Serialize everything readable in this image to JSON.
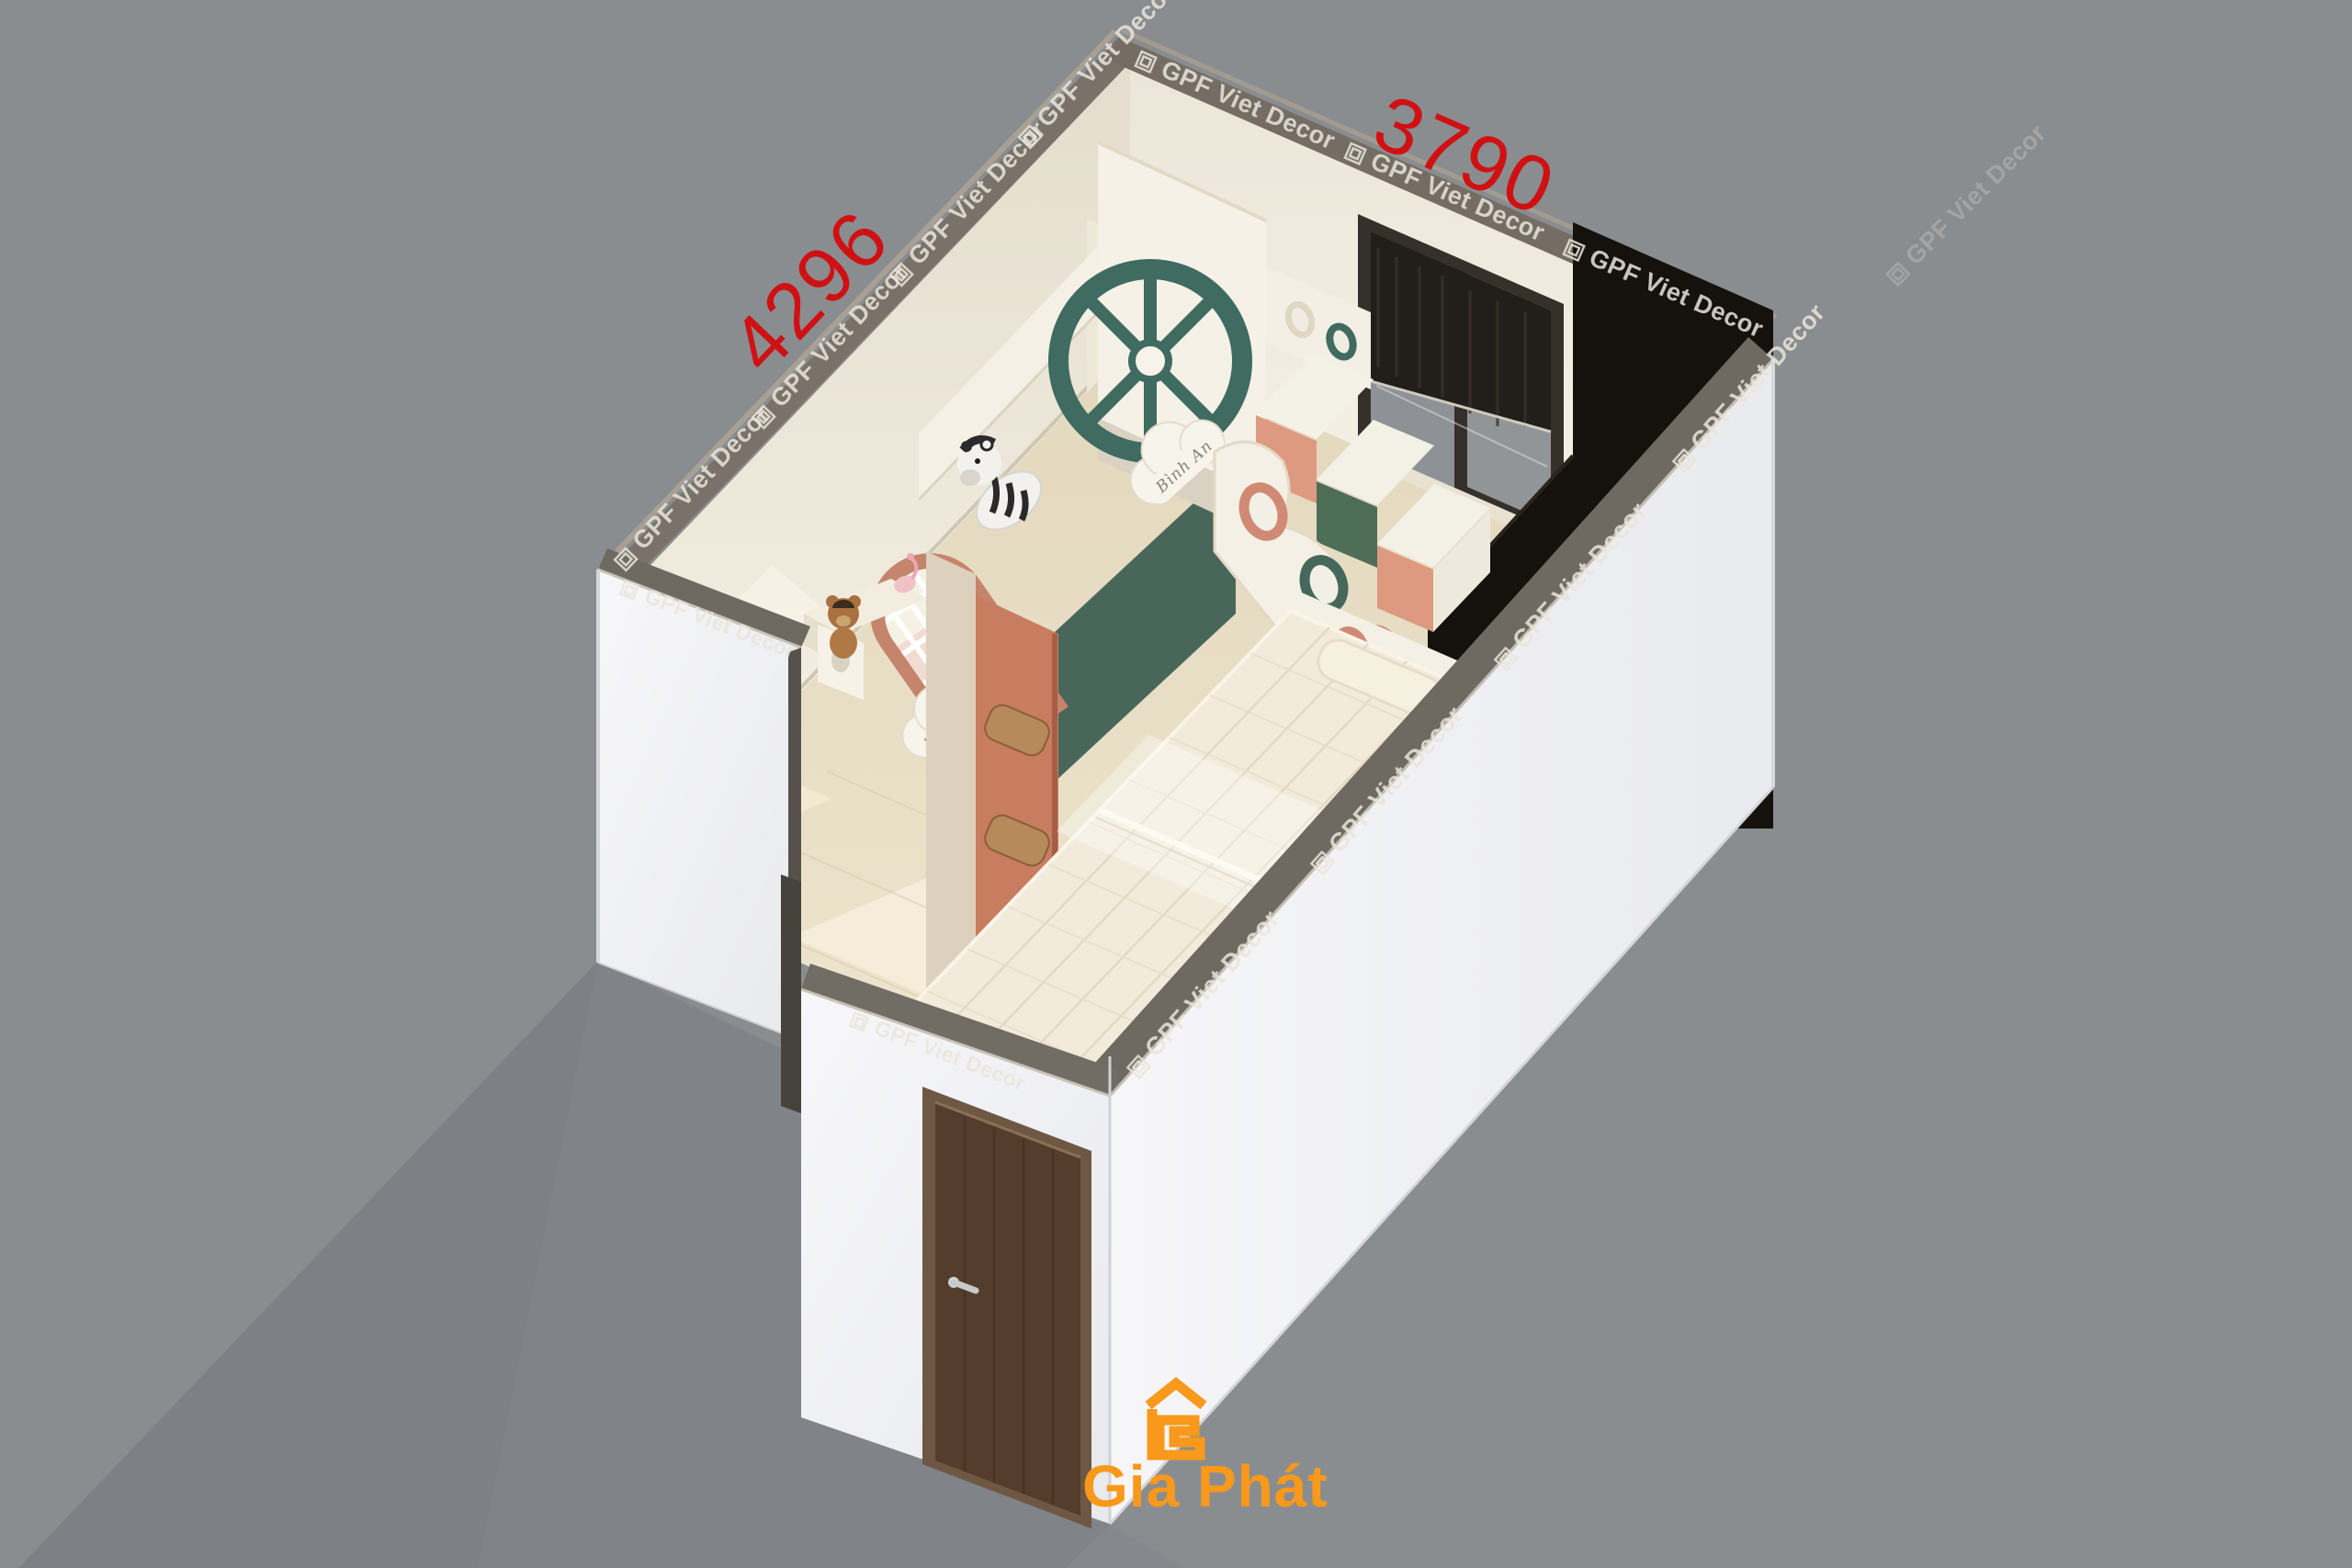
{
  "scene": {
    "type": "isometric-interior-render",
    "subject": "kids bedroom cutaway with bunk bed",
    "background_color": "#8a8d90"
  },
  "dimension_labels": {
    "left_wall": "4296",
    "back_wall": "3790",
    "color": "#d01114"
  },
  "watermark": {
    "text": "GPF Viet Decor"
  },
  "brand": {
    "name": "Gia Phát",
    "color": "#f8991c"
  },
  "bunk_bed": {
    "upper_bunk_nameplate": "Bình An",
    "lower_bunk_nameplate": "Bảo Anh"
  },
  "palette": {
    "wall_cream": "#efe9db",
    "floor_wood": "#e8dec6",
    "exterior_white": "#f5f5f8",
    "wall_cap_gray": "#6f6a62",
    "shadow_gray": "#7d8185",
    "teal_accent": "#3f6b61",
    "terracotta_accent": "#c87c60",
    "salmon_drawer": "#dd9a80",
    "green_drawer": "#4e6e58",
    "dark_green_panel": "#48675a",
    "bed_wood": "#7d4e2e",
    "mattress": "#f2ebdb",
    "door_brown": "#543d2c",
    "wardrobe_dark": "#15120e",
    "window_frame": "#35302a"
  }
}
